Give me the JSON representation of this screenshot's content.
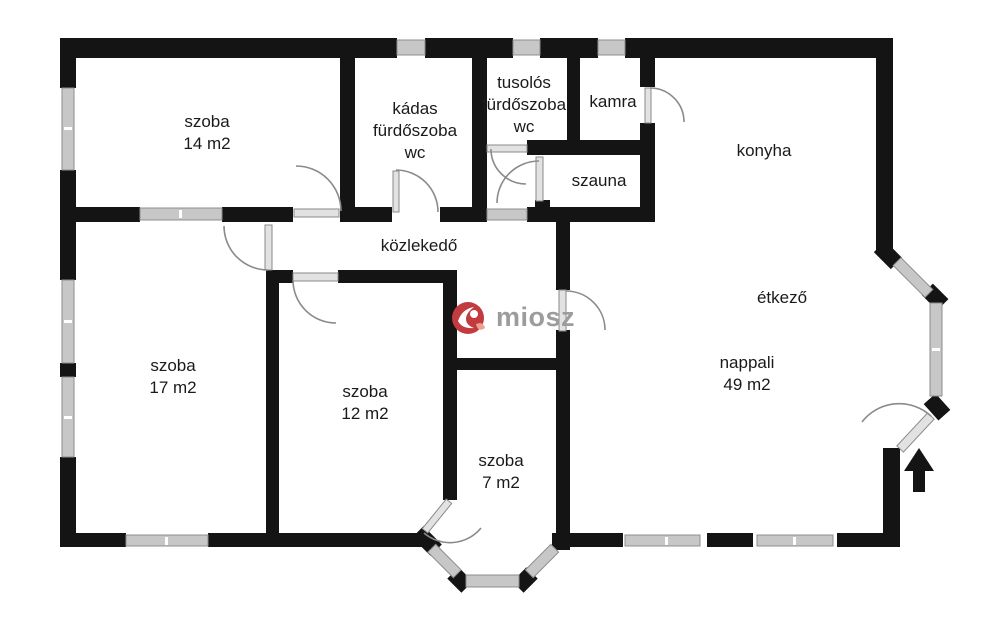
{
  "colors": {
    "bg": "#ffffff",
    "wall": "#141414",
    "win-fill": "#c7c7c7",
    "win-stroke": "#8e8e8e",
    "door": "#8a8a8a",
    "label": "#1a1a1a",
    "logo-red": "#c23b3f",
    "logo-accent": "#ef9f8d",
    "logo-text": "#9c9c9c"
  },
  "rooms": {
    "szoba14": {
      "lines": [
        "szoba",
        "14 m2"
      ]
    },
    "kadas": {
      "lines": [
        "kádas",
        "fürdőszoba",
        "wc"
      ]
    },
    "tusolos": {
      "lines": [
        "tusolós",
        "fürdőszoba",
        "wc"
      ]
    },
    "kamra": {
      "lines": [
        "kamra"
      ]
    },
    "konyha": {
      "lines": [
        "konyha"
      ]
    },
    "szauna": {
      "lines": [
        "szauna"
      ]
    },
    "kozlekedo": {
      "lines": [
        "közlekedő"
      ]
    },
    "szoba17": {
      "lines": [
        "szoba",
        "17 m2"
      ]
    },
    "szoba12": {
      "lines": [
        "szoba",
        "12 m2"
      ]
    },
    "szoba7": {
      "lines": [
        "szoba",
        "7 m2"
      ]
    },
    "etkezo": {
      "lines": [
        "étkező"
      ]
    },
    "nappali": {
      "lines": [
        "nappali",
        "49 m2"
      ]
    }
  },
  "watermark": {
    "text": "miosz"
  }
}
